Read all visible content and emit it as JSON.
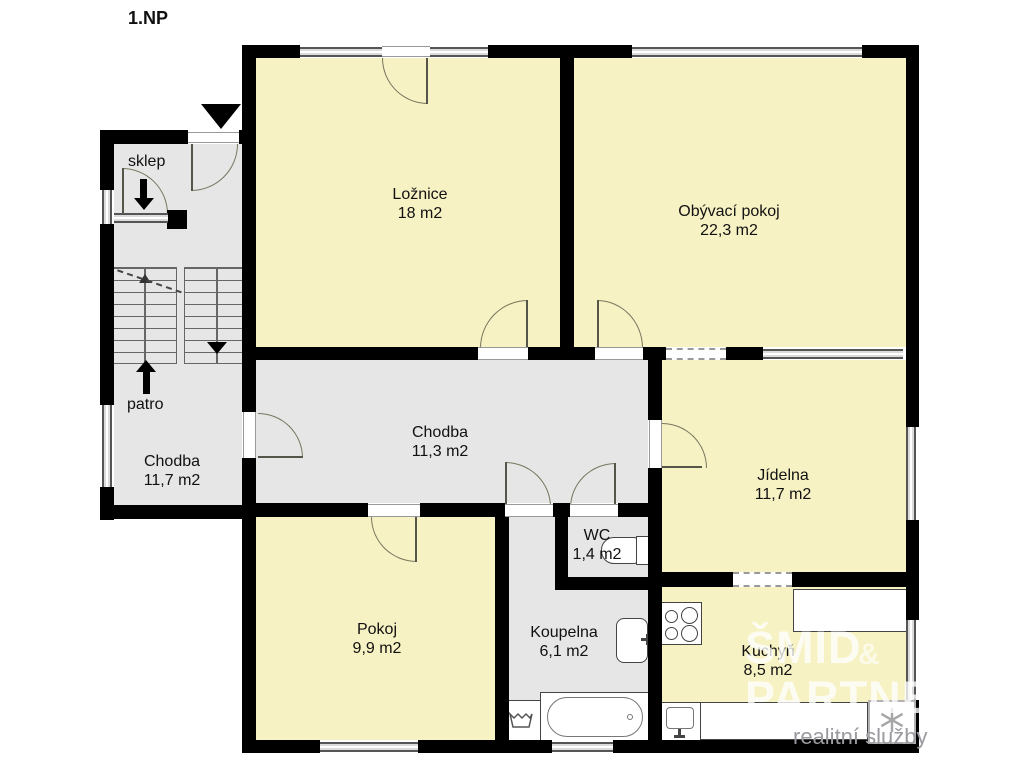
{
  "title": "1.NP",
  "rooms": {
    "loznice": {
      "name": "Ložnice",
      "area": "18 m2"
    },
    "obyvaci_pokoj": {
      "name": "Obývací pokoj",
      "area": "22,3 m2"
    },
    "chodba_hlavni": {
      "name": "Chodba",
      "area": "11,3 m2"
    },
    "chodba_leva": {
      "name": "Chodba",
      "area": "11,7 m2"
    },
    "jidelna": {
      "name": "Jídelna",
      "area": "11,7 m2"
    },
    "pokoj": {
      "name": "Pokoj",
      "area": "9,9 m2"
    },
    "koupelna": {
      "name": "Koupelna",
      "area": "6,1 m2"
    },
    "wc": {
      "name": "WC",
      "area": "1,4 m2"
    },
    "kuchyn": {
      "name": "Kuchyň",
      "area": "8,5 m2"
    }
  },
  "annotations": {
    "sklep": "sklep",
    "patro": "patro"
  },
  "watermark": {
    "line1": "ŠMÍD",
    "amp": "&",
    "line2": "PARTNEŘI",
    "line3": "realitní služby"
  },
  "colors": {
    "room_fill": "#F7F2C3",
    "corridor_fill": "#E6E6E6",
    "wall": "#000000",
    "window_fill": "#DBDBDB",
    "watermark_text": "#FFFFFF",
    "watermark_sub": "#9A9AA0"
  }
}
